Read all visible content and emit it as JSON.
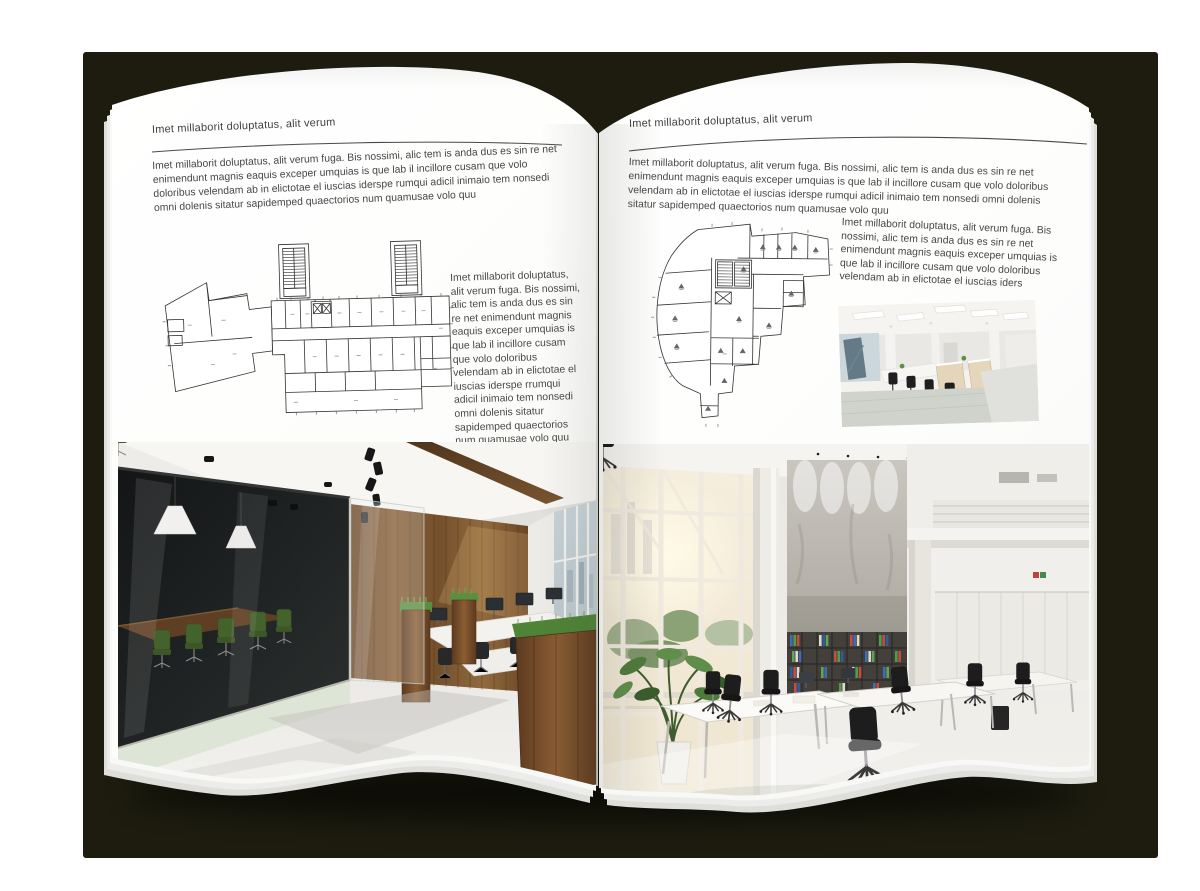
{
  "palette": {
    "backdrop": "#1d1c0f",
    "page": "#ffffff",
    "heading_text": "#3f3f3f",
    "body_text": "#474747",
    "rule_line": "#4a4a4a",
    "plan_line": "#333333",
    "wood_accent": "#7a5230",
    "meeting_chair_green": "#44622c",
    "binder_blue": "#3f6cb2",
    "binder_green": "#4f9c49",
    "binder_red": "#c14f41"
  },
  "left_page": {
    "header": "Imet millaborit doluptatus, alit verum",
    "intro": "Imet millaborit doluptatus, alit verum fuga. Bis nossimi, alic tem is anda dus es sin re net enimendunt magnis eaquis exceper umquias is que lab il incillore cusam que volo doloribus velendam ab in elictotae el iuscias iderspe rumqui adicil inimaio tem nonsedi omni dolenis sitatur sapidemped quaectorios num quamusae volo quu",
    "side_text": "Imet millaborit doluptatus, alit verum fuga. Bis nossimi, alic tem is anda dus es sin re net enimendunt magnis eaquis exceper umquias is que lab il incillore cusam que volo doloribus velendam ab in elictotae el iuscias iderspe rrumqui adicil inimaio tem nonsedi omni dolenis sitatur sapidemped quaectorios num quamusae volo quu"
  },
  "right_page": {
    "header": "Imet millaborit doluptatus, alit verum",
    "intro": "Imet millaborit doluptatus, alit verum fuga. Bis nossimi, alic tem is anda dus es sin re net enimendunt magnis eaquis exceper umquias is que lab il incillore cusam que volo doloribus velendam ab in elictotae el iuscias iderspe rumqui adicil inimaio tem nonsedi omni dolenis sitatur sapidemped quaectorios num quamusae volo quu",
    "side_text": "Imet millaborit doluptatus, alit verum fuga. Bis nossimi, alic tem is anda dus es sin re net enimendunt magnis eaquis exceper umquias is que lab il incillore cusam que volo doloribus velendam ab in elictotae el iuscias iders"
  }
}
